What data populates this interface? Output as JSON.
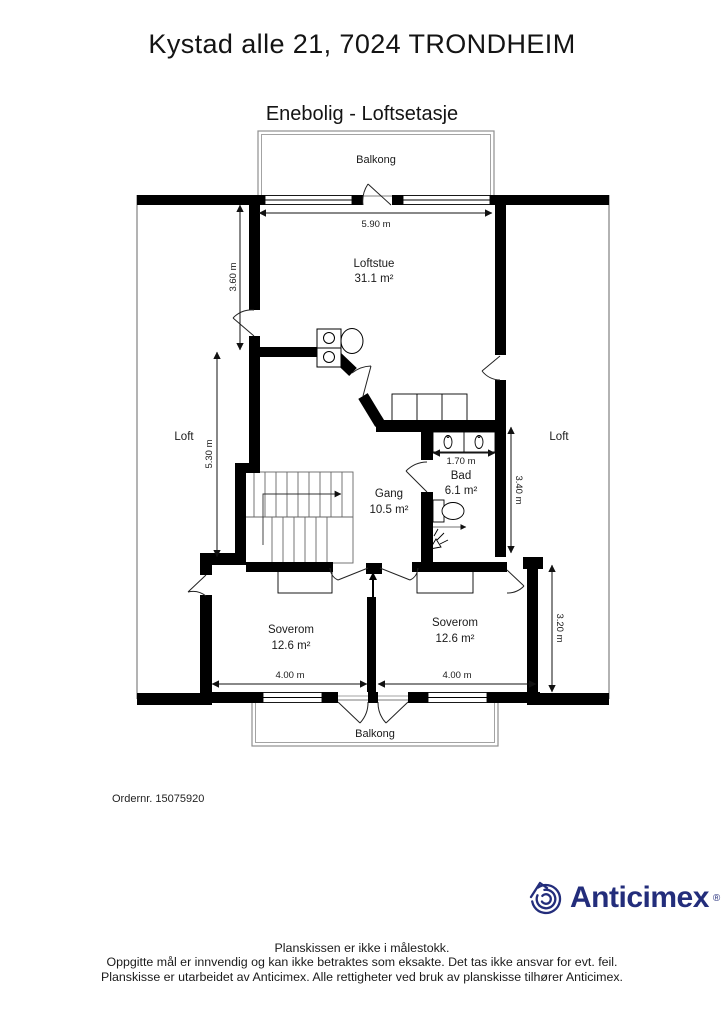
{
  "title": "Kystad alle 21, 7024 TRONDHEIM",
  "subtitle": "Enebolig - Loftsetasje",
  "order_number": "Ordernr. 15075920",
  "logo": {
    "brand": "Anticimex",
    "registered": "®"
  },
  "footer": {
    "line1": "Planskissen er ikke i målestokk.",
    "line2": "Oppgitte mål er innvendig og kan ikke betraktes som eksakte. Det tas ikke ansvar for evt. feil.",
    "line3": "Planskisse er utarbeidet av Anticimex. Alle rettigheter ved bruk av planskisse tilhører Anticimex."
  },
  "plan": {
    "balcony_top": "Balkong",
    "balcony_bottom": "Balkong",
    "loft_left": "Loft",
    "loft_right": "Loft",
    "rooms": [
      {
        "name": "Loftstue",
        "area": "31.1 m²"
      },
      {
        "name": "Gang",
        "area": "10.5 m²"
      },
      {
        "name": "Bad",
        "area": "6.1 m²"
      },
      {
        "name": "Soverom",
        "area": "12.6 m²"
      },
      {
        "name": "Soverom",
        "area": "12.6 m²"
      }
    ],
    "dimensions": [
      {
        "label": "5.90 m"
      },
      {
        "label": "3.60 m"
      },
      {
        "label": "5.30 m"
      },
      {
        "label": "1.70 m"
      },
      {
        "label": "3.40 m"
      },
      {
        "label": "3.20 m"
      },
      {
        "label": "4.00 m"
      },
      {
        "label": "4.00 m"
      }
    ]
  },
  "colors": {
    "wall": "#000000",
    "outline_gray": "#8a8a8a",
    "brand_navy": "#232d7b"
  }
}
